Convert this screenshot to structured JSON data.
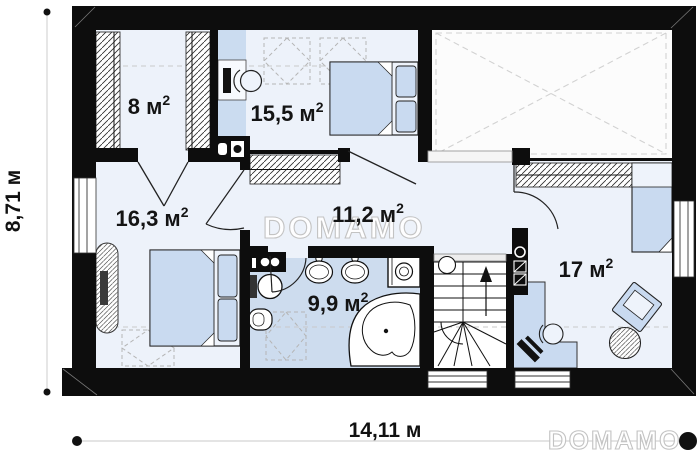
{
  "page": {
    "background": "#ffffff"
  },
  "palette": {
    "wall": "#0d0d0d",
    "floor": "#edf2fa",
    "bathroom_floor": "#cddcee",
    "furniture_fill": "#c9daf0",
    "outline": "#222222",
    "dashed_guides": "#c9c9c9",
    "watermark_outline": "#c3c3c3",
    "dimension_line": "#dcdcdc"
  },
  "rooms": [
    {
      "id": "bedroom-top-left",
      "area_label": "8 м²",
      "area_base": "8 м",
      "area_sup": "2"
    },
    {
      "id": "bedroom-top-middle",
      "area_label": "15,5 м²",
      "area_base": "15,5 м",
      "area_sup": "2"
    },
    {
      "id": "bedroom-left",
      "area_label": "16,3 м²",
      "area_base": "16,3 м",
      "area_sup": "2"
    },
    {
      "id": "hallway",
      "area_label": "11,2 м²",
      "area_base": "11,2 м",
      "area_sup": "2"
    },
    {
      "id": "bathroom",
      "area_label": "9,9 м²",
      "area_base": "9,9 м",
      "area_sup": "2"
    },
    {
      "id": "bedroom-right",
      "area_label": "17 м²",
      "area_base": "17 м",
      "area_sup": "2"
    }
  ],
  "dimensions": {
    "total_width": "14,11 м",
    "total_height": "8,71 м"
  },
  "watermark": {
    "brand": "DOMAMO"
  },
  "fixtures": [
    "wardrobe",
    "desk",
    "office-chair",
    "double-bed",
    "single-bed",
    "skylight",
    "roof-void",
    "radiator",
    "toilet",
    "bidet",
    "washbasin",
    "washing-machine",
    "corner-bathtub",
    "staircase",
    "armchair",
    "side-table"
  ]
}
